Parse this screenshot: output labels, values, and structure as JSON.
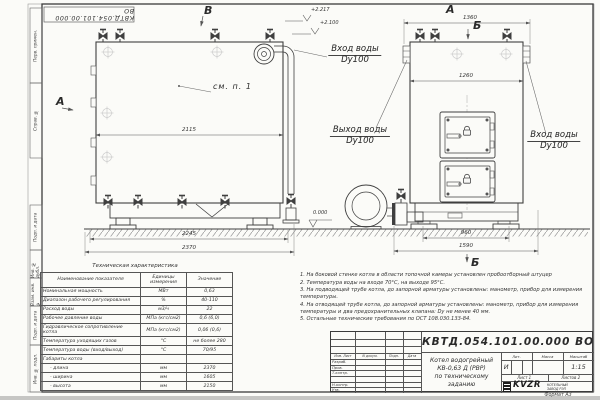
{
  "frame": {
    "stamp_top": "КВТД.054.101.00.000 ВО",
    "margin_labels": [
      "Перв. примен.",
      "Справ. №",
      "Подп. и дата",
      "Инв. № дубл.",
      "Взам. инв. №",
      "Подп. и дата",
      "Инв. № подл."
    ],
    "format": "Формат А3"
  },
  "annotations": {
    "view_b": "В",
    "view_a_left": "А",
    "view_a_right": "А",
    "section_b_top": "Б",
    "section_b_bottom": "Б",
    "callout": "см. п. 1",
    "dims": {
      "front_top": "2115",
      "front_mid": "2245",
      "front_bottom": "2370",
      "side_top": "1360",
      "side_inner": "1260",
      "side_base": "960",
      "side_base_full": "1590"
    },
    "elevations": {
      "e1": "+2.217",
      "e2": "+2.100",
      "e3": "0.000"
    },
    "pipes": {
      "front_in_1": "Вход воды",
      "front_in_2": "Dy100",
      "out_1": "Выход воды",
      "out_2": "Dy100",
      "side_in_1": "Вход воды",
      "side_in_2": "Dy100"
    }
  },
  "table": {
    "title": "Техническая характеристика",
    "headers": [
      "Наименование показателя",
      "Единицы измерения",
      "Значение"
    ],
    "rows": [
      [
        "Номинальная мощность",
        "МВт",
        "0,63"
      ],
      [
        "Диапазон рабочего регулирования",
        "%",
        "40-110"
      ],
      [
        "Расход воды",
        "м3/ч",
        "22"
      ],
      [
        "Рабочее давление воды",
        "МПа (кгс/см2)",
        "0,6 (6,0)"
      ],
      [
        "Гидравлическое сопротивление котла",
        "МПа (кгс/см2)",
        "0,06 (0,6)"
      ],
      [
        "Температура уходящих газов",
        "°С",
        "не более 280"
      ],
      [
        "Температура воды (вход/выход)",
        "°С",
        "70/95"
      ],
      [
        "Габариты котла",
        "",
        ""
      ],
      [
        "- длина",
        "мм",
        "2370"
      ],
      [
        "- ширина",
        "мм",
        "1605"
      ],
      [
        "- высота",
        "мм",
        "2150"
      ]
    ]
  },
  "notes": [
    "1. На боковой стенке котла в области топочной камеры установлен пробоотборный штуцер",
    "2. Температура воды на входе 70°С, на выходе 95°С.",
    "3. На подводящей трубе котла, до запорной арматуры установлены: манометр, прибор для измерения температуры.",
    "4. На отводящей трубе котла, до запорной арматуры установлены: манометр, прибор для измерения температуры и два предохранительных клапана: Dу не менее 40 мм.",
    "5. Остальные технические требования по ОСТ 108.030.133-84."
  ],
  "titleblock": {
    "doc_number": "КВТД.054.101.00.000  ВО",
    "title_l1": "Котел водогрейный",
    "title_l2": "КВ-0,63 Д (РВР)",
    "title_l3": "по техническому заданию",
    "header_cols": [
      "Изм. Лист",
      "N докум.",
      "Подп.",
      "Дата"
    ],
    "signer_rows": [
      "Разраб.",
      "Пров.",
      "Т.контр.",
      "",
      "Н.контр.",
      "Утв."
    ],
    "lit_label": "Лит.",
    "mass_label": "Масса",
    "scale_label": "Масштаб",
    "lit_value": "И",
    "scale_value": "1:15",
    "sheet_label": "Лист 1",
    "sheets_label": "Листов 2",
    "logo_text": "KVZR",
    "logo_sub1": "КОТЕЛЬНЫЙ",
    "logo_sub2": "ЗАВОД РЭП"
  }
}
